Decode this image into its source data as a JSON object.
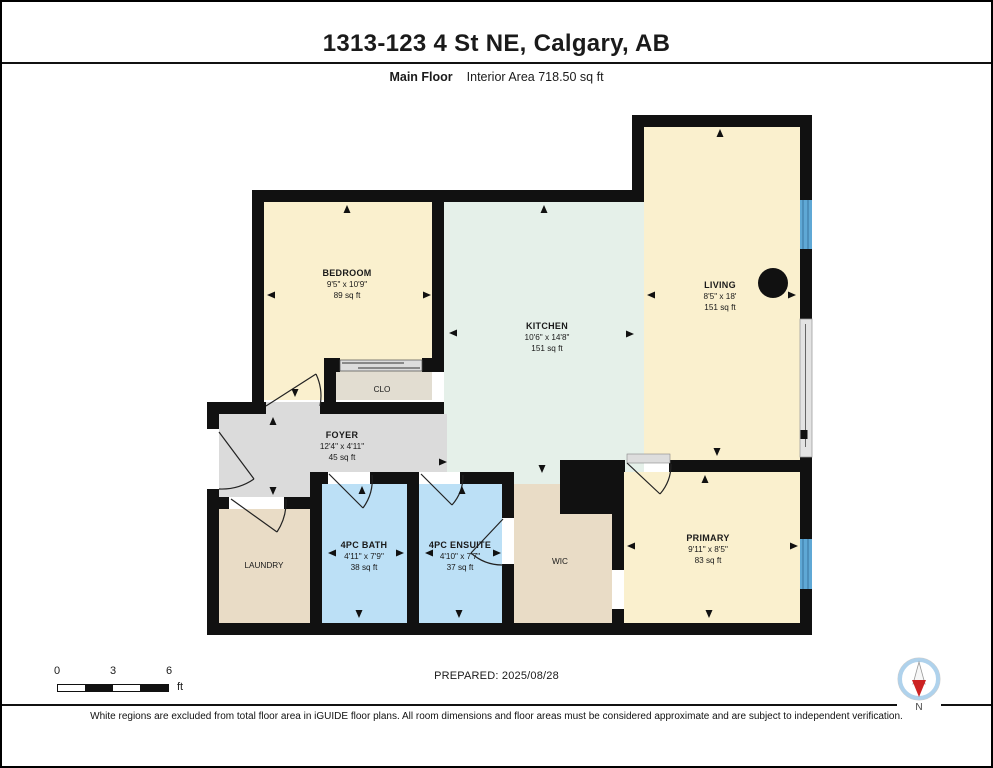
{
  "header": {
    "title": "1313-123 4 St NE, Calgary, AB",
    "floor_label": "Main Floor",
    "area_label": "Interior Area 718.50 sq ft"
  },
  "rooms": {
    "bedroom": {
      "name": "BEDROOM",
      "dims": "9'5\" x 10'9\"",
      "area": "89 sq ft"
    },
    "kitchen": {
      "name": "KITCHEN",
      "dims": "10'6\" x 14'8\"",
      "area": "151 sq ft"
    },
    "living": {
      "name": "LIVING",
      "dims": "8'5\" x 18'",
      "area": "151 sq ft"
    },
    "clo": {
      "name": "CLO"
    },
    "foyer": {
      "name": "FOYER",
      "dims": "12'4\" x 4'11\"",
      "area": "45 sq ft"
    },
    "laundry": {
      "name": "LAUNDRY"
    },
    "bath": {
      "name": "4PC BATH",
      "dims": "4'11\" x 7'9\"",
      "area": "38 sq ft"
    },
    "ensuite": {
      "name": "4PC ENSUITE",
      "dims": "4'10\" x 7'7\"",
      "area": "37 sq ft"
    },
    "wic": {
      "name": "WIC"
    },
    "primary": {
      "name": "PRIMARY",
      "dims": "9'11\" x 8'5\"",
      "area": "83 sq ft"
    }
  },
  "colors": {
    "wall": "#111111",
    "cream": "#FAF0CE",
    "mint": "#E5F0E9",
    "blue": "#BCE0F6",
    "tan": "#E9DCC6",
    "closet": "#E2DDD1",
    "gray": "#DBDBDB",
    "window": "#5FA8D5",
    "patio": "#E3E3E3",
    "compass_red": "#CC2222",
    "compass_ring": "#AFD2EC"
  },
  "footer": {
    "scale_ticks": [
      "0",
      "3",
      "6"
    ],
    "scale_unit": "ft",
    "prepared": "PREPARED: 2025/08/28",
    "compass_label": "N",
    "disclaimer": "White regions are excluded from total floor area in iGUIDE floor plans. All room dimensions and floor areas must be considered approximate and are subject to independent verification."
  }
}
